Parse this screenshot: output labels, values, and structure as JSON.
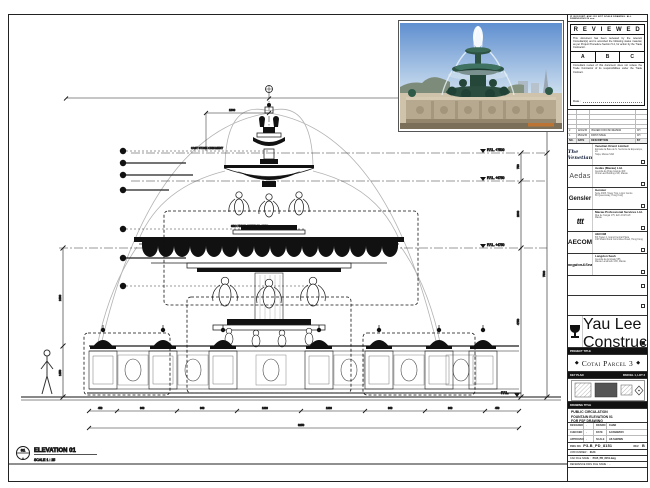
{
  "drawing": {
    "tag_number": "01",
    "tag_sheet": "-",
    "elevation_label": "ELEVATION 01",
    "elevation_scale": "SCALE 1 : 25",
    "levels": [
      "F.F.L. +7500",
      "F.F.L. +6750",
      "F.F.L. +4750",
      "F.F.L."
    ],
    "dims_right": [
      "750",
      "2000",
      "4750",
      "7500"
    ],
    "dims_left": [
      "2480",
      "1450"
    ],
    "dim_top": "1800",
    "dims_bottom": [
      "450",
      "960",
      "960",
      "1030",
      "1030",
      "960",
      "960",
      "450"
    ],
    "dim_overall": "8250",
    "notes": [
      "CAST STONE ORNAMENT",
      "GRC FINISH, REFER TO SPEC."
    ]
  },
  "titleblock": {
    "top_note": "IF IN DOUBT, ASK.  DO NOT SCALE DRAWING.  ALL DIMENSIONS IN mm.",
    "stamp": {
      "title": "R E V I E W E D",
      "body1": "This document has been reviewed by the relevant Consultant(s) and is accorded the following status material, as per Project Procedure Section 5.4, for action by the Trade Contractor.",
      "options": [
        "A",
        "B",
        "C"
      ],
      "body2": "Consultant review of this document does not relieve the Trade Contractor of its responsibilities under the Trade Contract.",
      "date_label": "Date :"
    },
    "revisions": {
      "headers": {
        "no": "NO.",
        "date": "DATE",
        "desc": "DESCRIPTION",
        "by": "BY"
      },
      "rows": [
        {
          "no": "2",
          "date": "12/01/15",
          "desc": "ISSUED FOR FSF REVIEW",
          "by": "CH"
        },
        {
          "no": "1",
          "date": "05/01/15",
          "desc": "FIRST ISSUE",
          "by": "CH"
        }
      ]
    },
    "consultants": [
      {
        "logo": "The Venetian",
        "name": "Venetian Orient Limited",
        "addr1": "Estrada da Baía de N. Senhora da Esperança, s/n",
        "addr2": "Taipa, Macau SAR"
      },
      {
        "logo": "Aedas",
        "name": "Aedas (Macau) Ltd.",
        "addr1": "Avenida da Praia Grande 409",
        "addr2": "China Law Building 21/F, Macau"
      },
      {
        "logo": "Gensler",
        "name": "Gensler",
        "addr1": "Suite 4305, Tower Two, Lippo Centre",
        "addr2": "89 Queensway, Hong Kong"
      },
      {
        "logo": "ttt",
        "name": "Macau Professional Services Ltd.",
        "addr1": "Rua de Xangai 175, Edf. ACM 11/F",
        "addr2": "Macau"
      },
      {
        "logo": "AECOM",
        "name": "AECOM",
        "addr1": "8/F Tower 2, Grand Central Plaza",
        "addr2": "138 Shatin Rural Committee Road, Hong Kong"
      },
      {
        "logo": "Langdon&Seah",
        "name": "Langdon Seah",
        "addr1": "Avenida da Amizade 555",
        "addr2": "Macau Landmark 13/F, Macau"
      }
    ],
    "contractor": {
      "name": "Yau Lee Construction",
      "name2": "(Macau) CO., LTD.",
      "addr1": "Avenida Comercial de Macau",
      "addr2": "AIA Tower 19/F, Macau"
    },
    "project": {
      "label": "PROJECT TITLE",
      "name": "Cotai Parcel 3",
      "ornament": "◆"
    },
    "key_plan": {
      "label": "KEY PLAN",
      "parcel": "PARCEL 1, LOT 3"
    },
    "drawing_title": {
      "label": "DRAWING TITLE",
      "line1": "PUBLIC CIRCULATION",
      "line2": "FOUNTAIN ELEVATION 01",
      "line3": "FOR FSF DRAWING"
    },
    "info": {
      "designed_label": "DESIGNED",
      "designed": "-",
      "drawn_label": "DRAWN",
      "drawn": "CHAD",
      "checked_label": "CHECKED",
      "checked": "-",
      "date_label": "DATE",
      "date": "12/JAN/2015",
      "approved_label": "APPROVED",
      "approved": "-",
      "scale_label": "SCALE",
      "scale": "AS SHOWN"
    },
    "dwg": {
      "no_label": "DWG NO.",
      "no": "P3-B_PD_8151",
      "rev_label": "REV.",
      "rev": "B",
      "job_label": "JOB NUMBER :",
      "job": "3123",
      "cad_label": "CAD FILE NAME :",
      "cad": "P3-B_PD_8151.dwg",
      "ref_label": "REFERENCE DWG FILE NAME :",
      "ref": "-"
    }
  }
}
